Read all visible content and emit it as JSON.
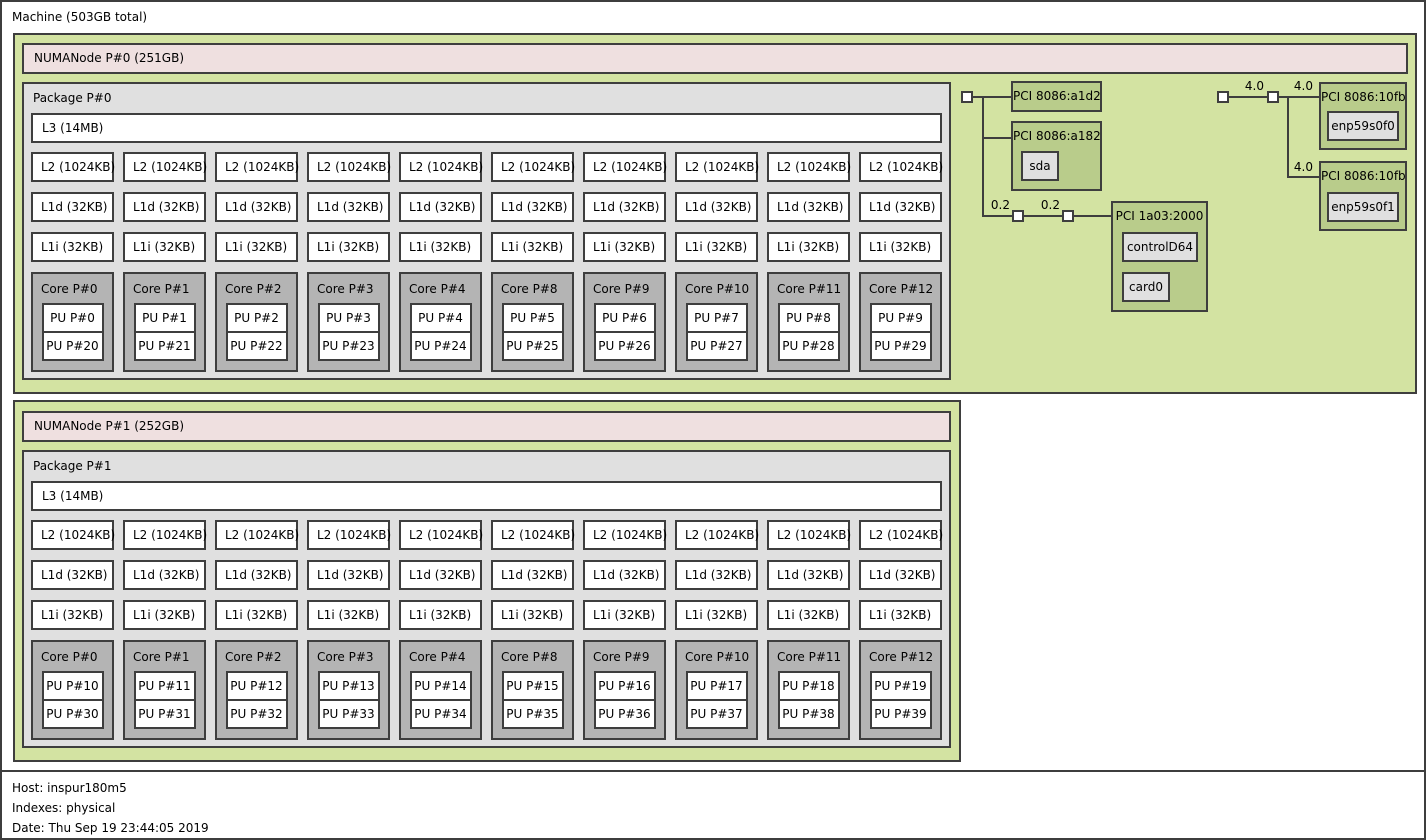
{
  "machine": {
    "title": "Machine (503GB total)"
  },
  "legend": {
    "host": "Host: inspur180m5",
    "indexes": "Indexes: physical",
    "date": "Date: Thu Sep 19 23:44:05 2019"
  },
  "numa_nodes": [
    {
      "label": "NUMANode P#0 (251GB)",
      "package_label": "Package P#0",
      "l3_label": "L3 (14MB)",
      "columns": [
        {
          "l2": "L2 (1024KB)",
          "l1d": "L1d (32KB)",
          "l1i": "L1i (32KB)",
          "core": "Core P#0",
          "pu_top": "PU P#0",
          "pu_bottom": "PU P#20"
        },
        {
          "l2": "L2 (1024KB)",
          "l1d": "L1d (32KB)",
          "l1i": "L1i (32KB)",
          "core": "Core P#1",
          "pu_top": "PU P#1",
          "pu_bottom": "PU P#21"
        },
        {
          "l2": "L2 (1024KB)",
          "l1d": "L1d (32KB)",
          "l1i": "L1i (32KB)",
          "core": "Core P#2",
          "pu_top": "PU P#2",
          "pu_bottom": "PU P#22"
        },
        {
          "l2": "L2 (1024KB)",
          "l1d": "L1d (32KB)",
          "l1i": "L1i (32KB)",
          "core": "Core P#3",
          "pu_top": "PU P#3",
          "pu_bottom": "PU P#23"
        },
        {
          "l2": "L2 (1024KB)",
          "l1d": "L1d (32KB)",
          "l1i": "L1i (32KB)",
          "core": "Core P#4",
          "pu_top": "PU P#4",
          "pu_bottom": "PU P#24"
        },
        {
          "l2": "L2 (1024KB)",
          "l1d": "L1d (32KB)",
          "l1i": "L1i (32KB)",
          "core": "Core P#8",
          "pu_top": "PU P#5",
          "pu_bottom": "PU P#25"
        },
        {
          "l2": "L2 (1024KB)",
          "l1d": "L1d (32KB)",
          "l1i": "L1i (32KB)",
          "core": "Core P#9",
          "pu_top": "PU P#6",
          "pu_bottom": "PU P#26"
        },
        {
          "l2": "L2 (1024KB)",
          "l1d": "L1d (32KB)",
          "l1i": "L1i (32KB)",
          "core": "Core P#10",
          "pu_top": "PU P#7",
          "pu_bottom": "PU P#27"
        },
        {
          "l2": "L2 (1024KB)",
          "l1d": "L1d (32KB)",
          "l1i": "L1i (32KB)",
          "core": "Core P#11",
          "pu_top": "PU P#8",
          "pu_bottom": "PU P#28"
        },
        {
          "l2": "L2 (1024KB)",
          "l1d": "L1d (32KB)",
          "l1i": "L1i (32KB)",
          "core": "Core P#12",
          "pu_top": "PU P#9",
          "pu_bottom": "PU P#29"
        }
      ]
    },
    {
      "label": "NUMANode P#1 (252GB)",
      "package_label": "Package P#1",
      "l3_label": "L3 (14MB)",
      "columns": [
        {
          "l2": "L2 (1024KB)",
          "l1d": "L1d (32KB)",
          "l1i": "L1i (32KB)",
          "core": "Core P#0",
          "pu_top": "PU P#10",
          "pu_bottom": "PU P#30"
        },
        {
          "l2": "L2 (1024KB)",
          "l1d": "L1d (32KB)",
          "l1i": "L1i (32KB)",
          "core": "Core P#1",
          "pu_top": "PU P#11",
          "pu_bottom": "PU P#31"
        },
        {
          "l2": "L2 (1024KB)",
          "l1d": "L1d (32KB)",
          "l1i": "L1i (32KB)",
          "core": "Core P#2",
          "pu_top": "PU P#12",
          "pu_bottom": "PU P#32"
        },
        {
          "l2": "L2 (1024KB)",
          "l1d": "L1d (32KB)",
          "l1i": "L1i (32KB)",
          "core": "Core P#3",
          "pu_top": "PU P#13",
          "pu_bottom": "PU P#33"
        },
        {
          "l2": "L2 (1024KB)",
          "l1d": "L1d (32KB)",
          "l1i": "L1i (32KB)",
          "core": "Core P#4",
          "pu_top": "PU P#14",
          "pu_bottom": "PU P#34"
        },
        {
          "l2": "L2 (1024KB)",
          "l1d": "L1d (32KB)",
          "l1i": "L1i (32KB)",
          "core": "Core P#8",
          "pu_top": "PU P#15",
          "pu_bottom": "PU P#35"
        },
        {
          "l2": "L2 (1024KB)",
          "l1d": "L1d (32KB)",
          "l1i": "L1i (32KB)",
          "core": "Core P#9",
          "pu_top": "PU P#16",
          "pu_bottom": "PU P#36"
        },
        {
          "l2": "L2 (1024KB)",
          "l1d": "L1d (32KB)",
          "l1i": "L1i (32KB)",
          "core": "Core P#10",
          "pu_top": "PU P#17",
          "pu_bottom": "PU P#37"
        },
        {
          "l2": "L2 (1024KB)",
          "l1d": "L1d (32KB)",
          "l1i": "L1i (32KB)",
          "core": "Core P#11",
          "pu_top": "PU P#18",
          "pu_bottom": "PU P#38"
        },
        {
          "l2": "L2 (1024KB)",
          "l1d": "L1d (32KB)",
          "l1i": "L1i (32KB)",
          "core": "Core P#12",
          "pu_top": "PU P#19",
          "pu_bottom": "PU P#39"
        }
      ]
    }
  ],
  "pci_left": {
    "link_labels": [
      "0.2",
      "0.2"
    ],
    "devices": [
      {
        "label": "PCI 8086:a1d2"
      },
      {
        "label": "PCI 8086:a182",
        "os_device": "sda"
      },
      {
        "label": "PCI 1a03:2000",
        "os_device": "controlD64",
        "os_device2": "card0"
      }
    ]
  },
  "pci_right": {
    "link_labels": [
      "4.0",
      "4.0",
      "4.0"
    ],
    "devices": [
      {
        "label": "PCI 8086:10fb",
        "os_device": "enp59s0f0"
      },
      {
        "label": "PCI 8086:10fb",
        "os_device": "enp59s0f1"
      }
    ]
  },
  "colors": {
    "numa_group_green": "#d3e3a2",
    "pci_device_green": "#b9cc8b",
    "numanode_pink": "#efe0e0",
    "package_gray": "#e0e0e0",
    "core_gray": "#b4b4b4",
    "cache_white": "#ffffff",
    "os_device_gray": "#e0e0e0",
    "border": "#3e3e3e"
  }
}
